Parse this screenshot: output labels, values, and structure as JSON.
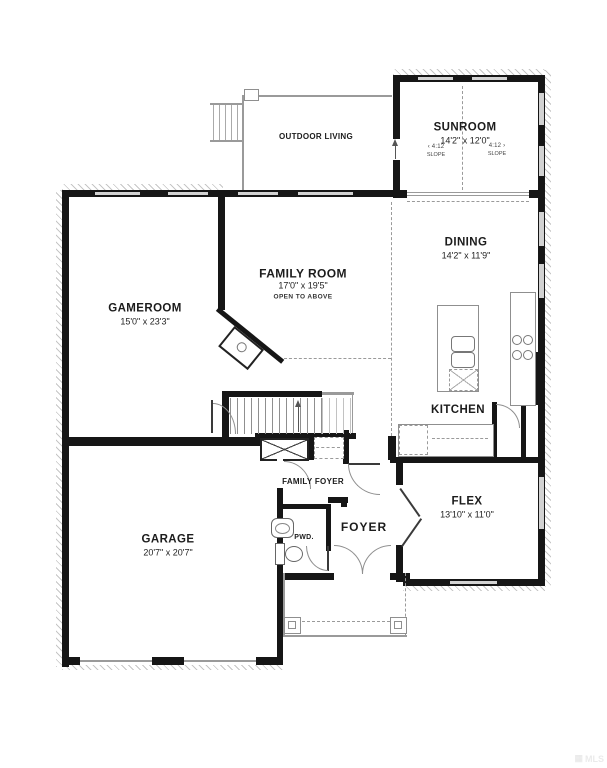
{
  "rooms": {
    "sunroom": {
      "name": "SUNROOM",
      "dims": "14'2\" x 12'0\""
    },
    "outdoor_living": {
      "name": "OUTDOOR LIVING"
    },
    "gameroom": {
      "name": "GAMEROOM",
      "dims": "15'0\" x 23'3\""
    },
    "family_room": {
      "name": "FAMILY ROOM",
      "dims": "17'0\" x 19'5\"",
      "note": "OPEN TO ABOVE"
    },
    "dining": {
      "name": "DINING",
      "dims": "14'2\" x 11'9\""
    },
    "kitchen": {
      "name": "KITCHEN"
    },
    "family_foyer": {
      "name": "FAMILY FOYER"
    },
    "foyer": {
      "name": "FOYER"
    },
    "powder": {
      "name": "PWD."
    },
    "flex": {
      "name": "FLEX",
      "dims": "13'10\" x 11'0\""
    },
    "garage": {
      "name": "GARAGE",
      "dims": "20'7\" x 20'7\""
    }
  },
  "roof": {
    "left": {
      "arrow": "‹",
      "ratio": "4:12",
      "label": "SLOPE"
    },
    "right": {
      "ratio": "4:12",
      "arrow": "›",
      "label": "SLOPE"
    }
  },
  "watermark": {
    "text": "MLS"
  },
  "colors": {
    "wall": "#161616",
    "window": "#d2d2d2",
    "line": "#9a9a9a",
    "text": "#1c1c1c"
  }
}
